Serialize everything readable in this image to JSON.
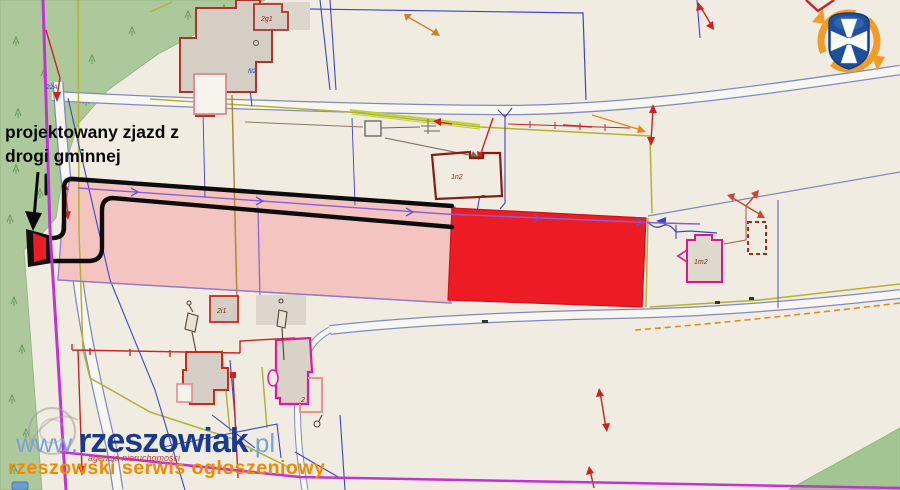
{
  "annotation": {
    "line1": "projektowany zjazd z",
    "line2": "drogi gminnej"
  },
  "watermark": {
    "www": "www.",
    "brand": "rzeszowiak",
    "tld": ".pl",
    "subtext": "agencja nieruchomości",
    "tagline": "rzeszowski serwis ogłoszeniowy"
  },
  "map_labels": {
    "building_top": "2g1",
    "building_mid": "1n2",
    "building_right": "1m2",
    "building_bottom_small": "2i1",
    "building_bottom": "2",
    "utility_a": "fil2",
    "utility_b": "22A"
  },
  "colors": {
    "highlight_parcel": "#ed1c24",
    "buffer_parcel": "#f4c5c0",
    "forest": "#adc99c",
    "boundary_magenta": "#c332d6",
    "logo_shield": "#1d4f9c",
    "logo_swirl": "#f59a23",
    "watermark_blue": "#1a3a8e",
    "watermark_light": "#7aa3d4",
    "watermark_orange": "#f28a00"
  },
  "logo": {
    "name": "rzeszow-region-crest"
  }
}
